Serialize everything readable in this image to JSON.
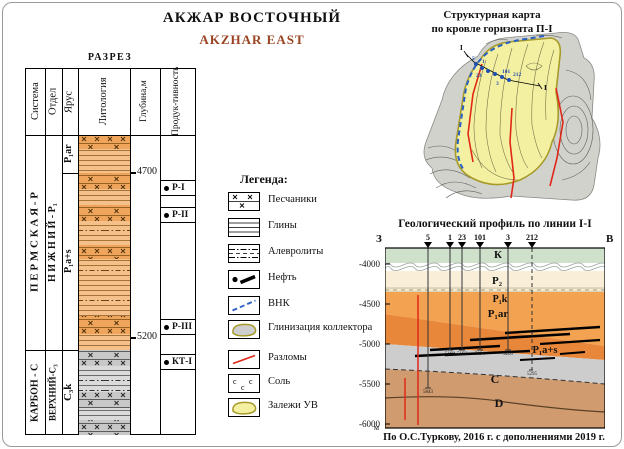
{
  "header": {
    "title_ru": "АКЖАР ВОСТОЧНЫЙ",
    "title_en": "AKZHAR EAST"
  },
  "colors": {
    "title_accent": "#9a4423",
    "permian_sand": "#efa55c",
    "permian_clay": "#f5c08a",
    "carbon_sand": "#c8c8c8",
    "carbon_clay": "#dadada",
    "map_deposit_yellow": "#f4f0a2",
    "map_background_gray": "#d2d2cd",
    "deposit_outline_olive": "#a69a28",
    "vnk_blue": "#2a5fc4",
    "fault_red": "#e02818",
    "profile_k_green": "#cfe0cb",
    "profile_p2_cream": "#f9efd9",
    "profile_orange": "#f2a250",
    "profile_dark_orange": "#e8873a",
    "profile_c_gray": "#cdcdcd",
    "profile_d_tan": "#d09b6e"
  },
  "column": {
    "title": "РАЗРЕЗ",
    "headers": {
      "system": "Система",
      "series": "Отдел",
      "stage": "Ярус",
      "lithology": "Литология",
      "depth": "Глубина,м",
      "productivity_1": "Продук-",
      "productivity_2": "тивность"
    },
    "system_permian": "П Е Р М С К А Я - Р",
    "system_carbon": "КАРБОН - С",
    "series_permian": "Н И Ж Н И Й - Р₁",
    "series_carbon": "ВЕРХНИЙ-С₃",
    "stage_p1ar": "P₁ar",
    "stage_p1as": "P₁a+s",
    "stage_c3k": "C₃k",
    "depth_4700": "4700",
    "depth_5200": "5200",
    "prod": [
      {
        "label": "Р-I"
      },
      {
        "label": "Р-II"
      },
      {
        "label": "Р-III"
      },
      {
        "label": "КТ-I"
      }
    ]
  },
  "legend": {
    "title": "Легенда:",
    "salt_symbol": "c",
    "items": [
      {
        "key": "sandstone",
        "label": "Песчаники"
      },
      {
        "key": "clay",
        "label": "Глины"
      },
      {
        "key": "siltstone",
        "label": "Алевролиты"
      },
      {
        "key": "oil",
        "label": "Нефть"
      },
      {
        "key": "vnk",
        "label": "ВНК"
      },
      {
        "key": "clayization",
        "label": "Глинизация коллектора"
      },
      {
        "key": "faults",
        "label": "Разломы"
      },
      {
        "key": "salt",
        "label": "Соль"
      },
      {
        "key": "hc-deposits",
        "label": "Залежи УВ"
      }
    ]
  },
  "map": {
    "title_1": "Структурная карта",
    "title_2": "по кровле горизонта П-I",
    "line_start": "I",
    "line_end": "I",
    "wells": [
      "5",
      "1",
      "23",
      "3",
      "101",
      "212"
    ]
  },
  "profile": {
    "title": "Геологический профиль по линии I-I",
    "west": "З",
    "east": "В",
    "unit": "м",
    "depth_ticks": [
      "-4000",
      "-4500",
      "-5000",
      "-5500",
      "-6000"
    ],
    "wells": [
      {
        "name": "5",
        "td": "5843"
      },
      {
        "name": "1",
        "td": "5192"
      },
      {
        "name": "23",
        "td": "5192"
      },
      {
        "name": "101",
        "td": "5196"
      },
      {
        "name": "3",
        "td": "5200"
      },
      {
        "name": "212",
        "td": "5295"
      }
    ],
    "layers": {
      "k": "К",
      "p2": "P₂",
      "p1k": "P₁k",
      "p1ar": "P₁ar",
      "p1as": "P₁a+s",
      "c": "C",
      "d": "D"
    }
  },
  "caption": "По О.С.Туркову, 2016 г. с дополнениями 2019 г."
}
